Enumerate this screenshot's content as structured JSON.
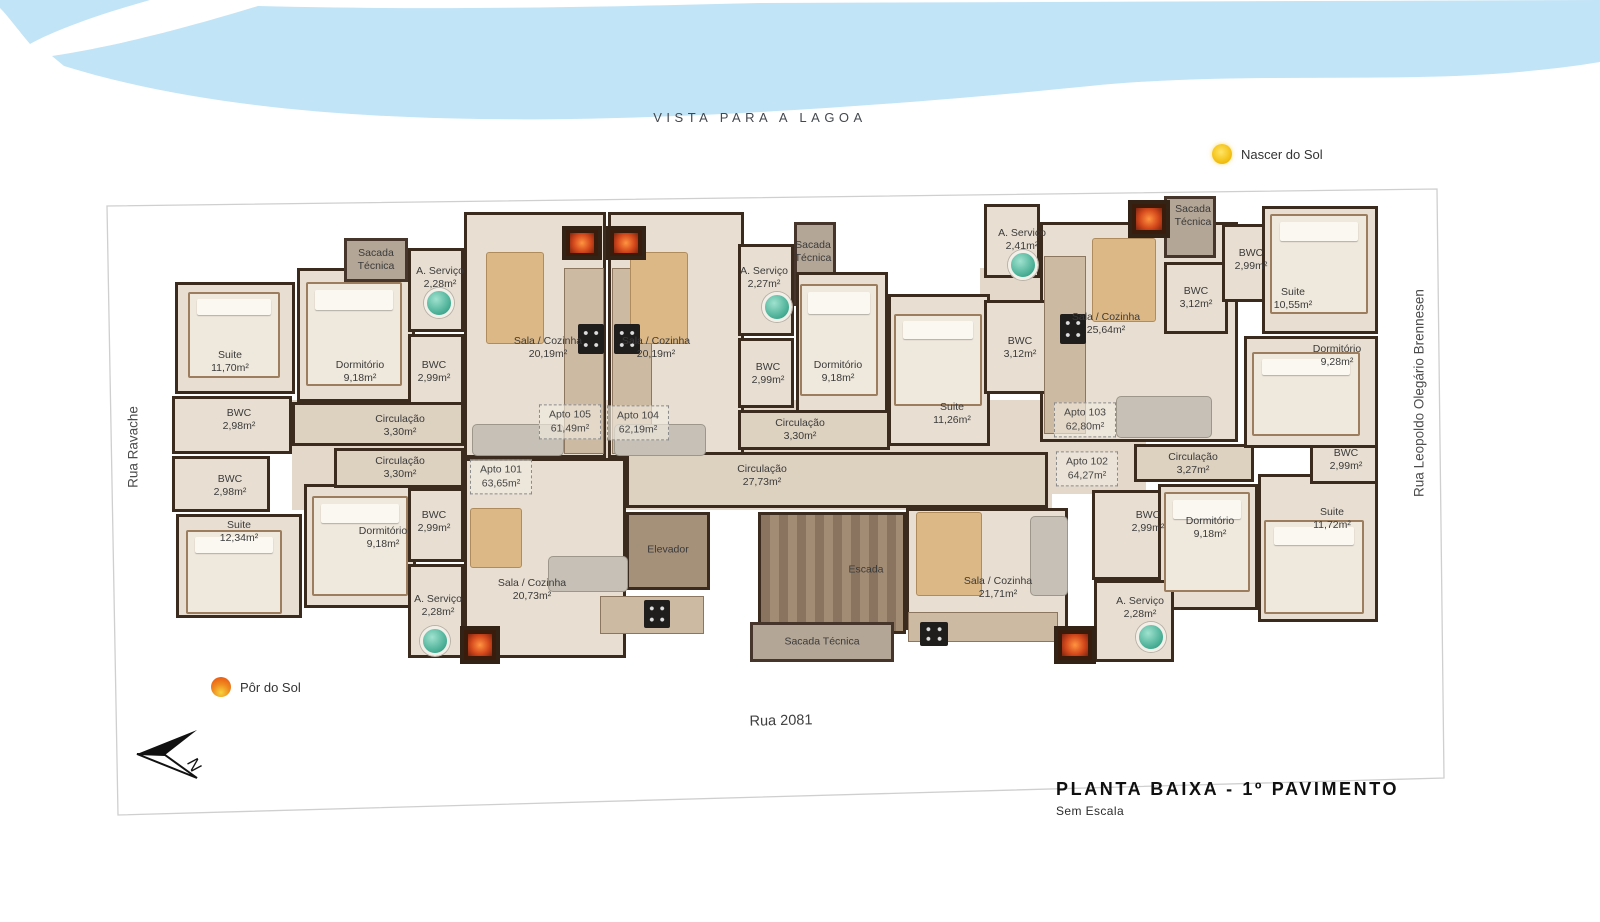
{
  "labels": {
    "vista": "VISTA PARA A LAGOA",
    "north": "N"
  },
  "legend": {
    "sunrise": "Nascer do Sol",
    "sunset": "Pôr do Sol"
  },
  "streets": {
    "left": "Rua Ravache",
    "right": "Rua Leopoldo Olegário Brennesen",
    "bottom": "Rua 2081"
  },
  "title": {
    "main": "PLANTA BAIXA - 1º PAVIMENTO",
    "sub": "Sem Escala"
  },
  "colors": {
    "water": "#c2e4f7",
    "wall": "#3b2b1e",
    "floor": "#e8dfd2",
    "boundary": "#cfcfcf",
    "sun_yellow": "#f3c116",
    "sun_orange": "#e8490f"
  },
  "plan": {
    "base": [
      {
        "x": 292,
        "y": 400,
        "w": 760,
        "h": 110
      },
      {
        "x": 1036,
        "y": 440,
        "w": 110,
        "h": 54
      },
      {
        "x": 980,
        "y": 268,
        "w": 64,
        "h": 40
      }
    ],
    "rooms": [
      {
        "id": "suite-1170",
        "x": 175,
        "y": 282,
        "w": 120,
        "h": 112,
        "k": ""
      },
      {
        "id": "dormitorio-918-a",
        "x": 297,
        "y": 268,
        "w": 118,
        "h": 134,
        "k": ""
      },
      {
        "id": "sacada-tecnica-1",
        "x": 344,
        "y": 238,
        "w": 64,
        "h": 44,
        "k": "balc"
      },
      {
        "id": "a-servico-228-a",
        "x": 408,
        "y": 248,
        "w": 56,
        "h": 84,
        "k": ""
      },
      {
        "id": "bwc-299-a",
        "x": 408,
        "y": 334,
        "w": 56,
        "h": 72,
        "k": ""
      },
      {
        "id": "bwc-298-a",
        "x": 172,
        "y": 396,
        "w": 120,
        "h": 58,
        "k": ""
      },
      {
        "id": "bwc-298-b",
        "x": 172,
        "y": 456,
        "w": 98,
        "h": 56,
        "k": ""
      },
      {
        "id": "suite-1234",
        "x": 176,
        "y": 514,
        "w": 126,
        "h": 104,
        "k": ""
      },
      {
        "id": "dormitorio-918-b",
        "x": 304,
        "y": 484,
        "w": 112,
        "h": 124,
        "k": ""
      },
      {
        "id": "circulacao-330-a",
        "x": 292,
        "y": 402,
        "w": 172,
        "h": 44,
        "k": "cor"
      },
      {
        "id": "circulacao-330-b",
        "x": 334,
        "y": 448,
        "w": 130,
        "h": 40,
        "k": "cor"
      },
      {
        "id": "bwc-299-low",
        "x": 408,
        "y": 488,
        "w": 56,
        "h": 74,
        "k": ""
      },
      {
        "id": "a-servico-228-low",
        "x": 408,
        "y": 564,
        "w": 56,
        "h": 94,
        "k": ""
      },
      {
        "id": "sala-cozinha-2019-a",
        "x": 464,
        "y": 212,
        "w": 142,
        "h": 246,
        "k": ""
      },
      {
        "id": "sala-cozinha-2019-b",
        "x": 608,
        "y": 212,
        "w": 136,
        "h": 246,
        "k": ""
      },
      {
        "id": "sala-cozinha-2073",
        "x": 464,
        "y": 458,
        "w": 162,
        "h": 200,
        "k": ""
      },
      {
        "id": "circulacao-2773",
        "x": 626,
        "y": 452,
        "w": 422,
        "h": 56,
        "k": "cor"
      },
      {
        "id": "elevador",
        "x": 626,
        "y": 512,
        "w": 84,
        "h": 78,
        "k": "elev"
      },
      {
        "id": "a-servico-227",
        "x": 738,
        "y": 244,
        "w": 56,
        "h": 92,
        "k": ""
      },
      {
        "id": "sacada-tecnica-2",
        "x": 794,
        "y": 222,
        "w": 42,
        "h": 84,
        "k": "balc"
      },
      {
        "id": "bwc-299-b",
        "x": 738,
        "y": 338,
        "w": 56,
        "h": 70,
        "k": ""
      },
      {
        "id": "dormitorio-918-c",
        "x": 796,
        "y": 272,
        "w": 92,
        "h": 142,
        "k": ""
      },
      {
        "id": "suite-1126",
        "x": 888,
        "y": 294,
        "w": 102,
        "h": 152,
        "k": ""
      },
      {
        "id": "circulacao-330-c",
        "x": 738,
        "y": 410,
        "w": 152,
        "h": 40,
        "k": "cor"
      },
      {
        "id": "escada",
        "x": 758,
        "y": 512,
        "w": 148,
        "h": 122,
        "k": "stair"
      },
      {
        "id": "sacada-tecnica-3",
        "x": 750,
        "y": 622,
        "w": 144,
        "h": 40,
        "k": "balc"
      },
      {
        "id": "sala-cozinha-2171",
        "x": 906,
        "y": 508,
        "w": 162,
        "h": 122,
        "k": ""
      },
      {
        "id": "bwc-299-c",
        "x": 1092,
        "y": 490,
        "w": 84,
        "h": 90,
        "k": ""
      },
      {
        "id": "dormitorio-918-d",
        "x": 1158,
        "y": 484,
        "w": 100,
        "h": 126,
        "k": ""
      },
      {
        "id": "a-servico-228-b",
        "x": 1094,
        "y": 580,
        "w": 80,
        "h": 82,
        "k": ""
      },
      {
        "id": "suite-1172",
        "x": 1258,
        "y": 474,
        "w": 120,
        "h": 148,
        "k": ""
      },
      {
        "id": "circulacao-327",
        "x": 1134,
        "y": 444,
        "w": 120,
        "h": 38,
        "k": "cor"
      },
      {
        "id": "bwc-299-d",
        "x": 1310,
        "y": 430,
        "w": 68,
        "h": 54,
        "k": ""
      },
      {
        "id": "sala-cozinha-2564",
        "x": 1040,
        "y": 222,
        "w": 198,
        "h": 220,
        "k": ""
      },
      {
        "id": "a-servico-241",
        "x": 984,
        "y": 204,
        "w": 56,
        "h": 74,
        "k": ""
      },
      {
        "id": "bwc-312-a",
        "x": 984,
        "y": 300,
        "w": 78,
        "h": 94,
        "k": ""
      },
      {
        "id": "bwc-312-b",
        "x": 1164,
        "y": 262,
        "w": 64,
        "h": 72,
        "k": ""
      },
      {
        "id": "sacada-tecnica-4",
        "x": 1164,
        "y": 196,
        "w": 52,
        "h": 62,
        "k": "balc"
      },
      {
        "id": "bwc-299-e",
        "x": 1222,
        "y": 224,
        "w": 60,
        "h": 78,
        "k": ""
      },
      {
        "id": "suite-1055",
        "x": 1262,
        "y": 206,
        "w": 116,
        "h": 128,
        "k": ""
      },
      {
        "id": "dormitorio-928",
        "x": 1244,
        "y": 336,
        "w": 134,
        "h": 112,
        "k": ""
      }
    ],
    "labels": [
      {
        "t": "Suite",
        "a": "11,70m²",
        "x": 230,
        "y": 362
      },
      {
        "t": "Dormitório",
        "a": "9,18m²",
        "x": 360,
        "y": 372
      },
      {
        "t": "BWC",
        "a": "2,99m²",
        "x": 434,
        "y": 372
      },
      {
        "t": "A. Serviço",
        "a": "2,28m²",
        "x": 440,
        "y": 278
      },
      {
        "t": "Sacada",
        "a": "Técnica",
        "x": 376,
        "y": 260
      },
      {
        "t": "BWC",
        "a": "2,98m²",
        "x": 239,
        "y": 420
      },
      {
        "t": "BWC",
        "a": "2,98m²",
        "x": 230,
        "y": 486
      },
      {
        "t": "Suite",
        "a": "12,34m²",
        "x": 239,
        "y": 532
      },
      {
        "t": "Dormitório",
        "a": "9,18m²",
        "x": 383,
        "y": 538
      },
      {
        "t": "Circulação",
        "a": "3,30m²",
        "x": 400,
        "y": 426
      },
      {
        "t": "Circulação",
        "a": "3,30m²",
        "x": 400,
        "y": 468
      },
      {
        "t": "BWC",
        "a": "2,99m²",
        "x": 434,
        "y": 522
      },
      {
        "t": "A. Serviço",
        "a": "2,28m²",
        "x": 438,
        "y": 606
      },
      {
        "t": "Sala / Cozinha",
        "a": "20,19m²",
        "x": 548,
        "y": 348
      },
      {
        "t": "Sala / Cozinha",
        "a": "20,19m²",
        "x": 656,
        "y": 348
      },
      {
        "t": "Sala / Cozinha",
        "a": "20,73m²",
        "x": 532,
        "y": 590
      },
      {
        "t": "A. Serviço",
        "a": "2,27m²",
        "x": 764,
        "y": 278
      },
      {
        "t": "Sacada",
        "a": "Técnica",
        "x": 813,
        "y": 252
      },
      {
        "t": "BWC",
        "a": "2,99m²",
        "x": 768,
        "y": 374
      },
      {
        "t": "Dormitório",
        "a": "9,18m²",
        "x": 838,
        "y": 372
      },
      {
        "t": "Suite",
        "a": "11,26m²",
        "x": 952,
        "y": 414
      },
      {
        "t": "Circulação",
        "a": "3,30m²",
        "x": 800,
        "y": 430
      },
      {
        "t": "Circulação",
        "a": "27,73m²",
        "x": 762,
        "y": 476
      },
      {
        "t": "Elevador",
        "a": "",
        "x": 668,
        "y": 550
      },
      {
        "t": "Escada",
        "a": "",
        "x": 866,
        "y": 570
      },
      {
        "t": "Sacada Técnica",
        "a": "",
        "x": 822,
        "y": 642
      },
      {
        "t": "Sala / Cozinha",
        "a": "21,71m²",
        "x": 998,
        "y": 588
      },
      {
        "t": "A. Serviço",
        "a": "2,28m²",
        "x": 1140,
        "y": 608
      },
      {
        "t": "BWC",
        "a": "2,99m²",
        "x": 1148,
        "y": 522
      },
      {
        "t": "Dormitório",
        "a": "9,18m²",
        "x": 1210,
        "y": 528
      },
      {
        "t": "Suite",
        "a": "11,72m²",
        "x": 1332,
        "y": 519
      },
      {
        "t": "BWC",
        "a": "2,99m²",
        "x": 1346,
        "y": 460
      },
      {
        "t": "Circulação",
        "a": "3,27m²",
        "x": 1193,
        "y": 464
      },
      {
        "t": "Sala / Cozinha",
        "a": "25,64m²",
        "x": 1106,
        "y": 324
      },
      {
        "t": "A. Serviço",
        "a": "2,41m²",
        "x": 1022,
        "y": 240
      },
      {
        "t": "BWC",
        "a": "3,12m²",
        "x": 1020,
        "y": 348
      },
      {
        "t": "BWC",
        "a": "3,12m²",
        "x": 1196,
        "y": 298
      },
      {
        "t": "Sacada",
        "a": "Técnica",
        "x": 1193,
        "y": 216
      },
      {
        "t": "BWC",
        "a": "2,99m²",
        "x": 1251,
        "y": 260
      },
      {
        "t": "Suite",
        "a": "10,55m²",
        "x": 1293,
        "y": 299
      },
      {
        "t": "Dormitório",
        "a": "9,28m²",
        "x": 1337,
        "y": 356
      }
    ],
    "units": [
      {
        "l1": "Apto 105",
        "l2": "61,49m²",
        "x": 570,
        "y": 422
      },
      {
        "l1": "Apto 104",
        "l2": "62,19m²",
        "x": 638,
        "y": 423
      },
      {
        "l1": "Apto 101",
        "l2": "63,65m²",
        "x": 501,
        "y": 477
      },
      {
        "l1": "Apto 102",
        "l2": "64,27m²",
        "x": 1087,
        "y": 469
      },
      {
        "l1": "Apto 103",
        "l2": "62,80m²",
        "x": 1085,
        "y": 420
      }
    ],
    "furniture": [
      {
        "t": "bed",
        "x": 188,
        "y": 292,
        "w": 92,
        "h": 86
      },
      {
        "t": "bed",
        "x": 306,
        "y": 282,
        "w": 96,
        "h": 104
      },
      {
        "t": "bed",
        "x": 186,
        "y": 530,
        "w": 96,
        "h": 84
      },
      {
        "t": "bed",
        "x": 312,
        "y": 496,
        "w": 96,
        "h": 100
      },
      {
        "t": "bed",
        "x": 800,
        "y": 284,
        "w": 78,
        "h": 112
      },
      {
        "t": "bed",
        "x": 894,
        "y": 314,
        "w": 88,
        "h": 92
      },
      {
        "t": "bed",
        "x": 1270,
        "y": 214,
        "w": 98,
        "h": 100
      },
      {
        "t": "bed",
        "x": 1252,
        "y": 352,
        "w": 108,
        "h": 84
      },
      {
        "t": "bed",
        "x": 1164,
        "y": 492,
        "w": 86,
        "h": 100
      },
      {
        "t": "bed",
        "x": 1264,
        "y": 520,
        "w": 100,
        "h": 94
      },
      {
        "t": "counter",
        "x": 564,
        "y": 268,
        "w": 40,
        "h": 186
      },
      {
        "t": "counter",
        "x": 612,
        "y": 268,
        "w": 40,
        "h": 186
      },
      {
        "t": "counter",
        "x": 1044,
        "y": 256,
        "w": 42,
        "h": 178
      },
      {
        "t": "counter",
        "x": 600,
        "y": 596,
        "w": 104,
        "h": 38
      },
      {
        "t": "counter",
        "x": 908,
        "y": 612,
        "w": 150,
        "h": 30
      },
      {
        "t": "table",
        "x": 486,
        "y": 252,
        "w": 58,
        "h": 92
      },
      {
        "t": "table",
        "x": 630,
        "y": 252,
        "w": 58,
        "h": 92
      },
      {
        "t": "table",
        "x": 1092,
        "y": 238,
        "w": 64,
        "h": 84
      },
      {
        "t": "table",
        "x": 916,
        "y": 512,
        "w": 66,
        "h": 84
      },
      {
        "t": "table",
        "x": 470,
        "y": 508,
        "w": 52,
        "h": 60
      },
      {
        "t": "sofa",
        "x": 472,
        "y": 424,
        "w": 92,
        "h": 32
      },
      {
        "t": "sofa",
        "x": 614,
        "y": 424,
        "w": 92,
        "h": 32
      },
      {
        "t": "sofa",
        "x": 548,
        "y": 556,
        "w": 80,
        "h": 36
      },
      {
        "t": "sofa",
        "x": 1030,
        "y": 516,
        "w": 38,
        "h": 80
      },
      {
        "t": "sofa",
        "x": 1116,
        "y": 396,
        "w": 96,
        "h": 42
      },
      {
        "t": "washer",
        "x": 424,
        "y": 288,
        "w": 30,
        "h": 30
      },
      {
        "t": "washer",
        "x": 762,
        "y": 292,
        "w": 30,
        "h": 30
      },
      {
        "t": "washer",
        "x": 1008,
        "y": 250,
        "w": 30,
        "h": 30
      },
      {
        "t": "washer",
        "x": 420,
        "y": 626,
        "w": 30,
        "h": 30
      },
      {
        "t": "washer",
        "x": 1136,
        "y": 622,
        "w": 30,
        "h": 30
      },
      {
        "t": "stove",
        "x": 578,
        "y": 324,
        "w": 26,
        "h": 30
      },
      {
        "t": "stove",
        "x": 614,
        "y": 324,
        "w": 26,
        "h": 30
      },
      {
        "t": "stove",
        "x": 1060,
        "y": 314,
        "w": 26,
        "h": 30
      },
      {
        "t": "stove",
        "x": 644,
        "y": 600,
        "w": 26,
        "h": 28
      },
      {
        "t": "stove",
        "x": 920,
        "y": 622,
        "w": 28,
        "h": 24
      },
      {
        "t": "fire",
        "x": 562,
        "y": 226,
        "w": 40,
        "h": 34
      },
      {
        "t": "fire",
        "x": 606,
        "y": 226,
        "w": 40,
        "h": 34
      },
      {
        "t": "fire",
        "x": 1128,
        "y": 200,
        "w": 42,
        "h": 38
      },
      {
        "t": "fire",
        "x": 460,
        "y": 626,
        "w": 40,
        "h": 38
      },
      {
        "t": "fire",
        "x": 1054,
        "y": 626,
        "w": 42,
        "h": 38
      }
    ]
  }
}
